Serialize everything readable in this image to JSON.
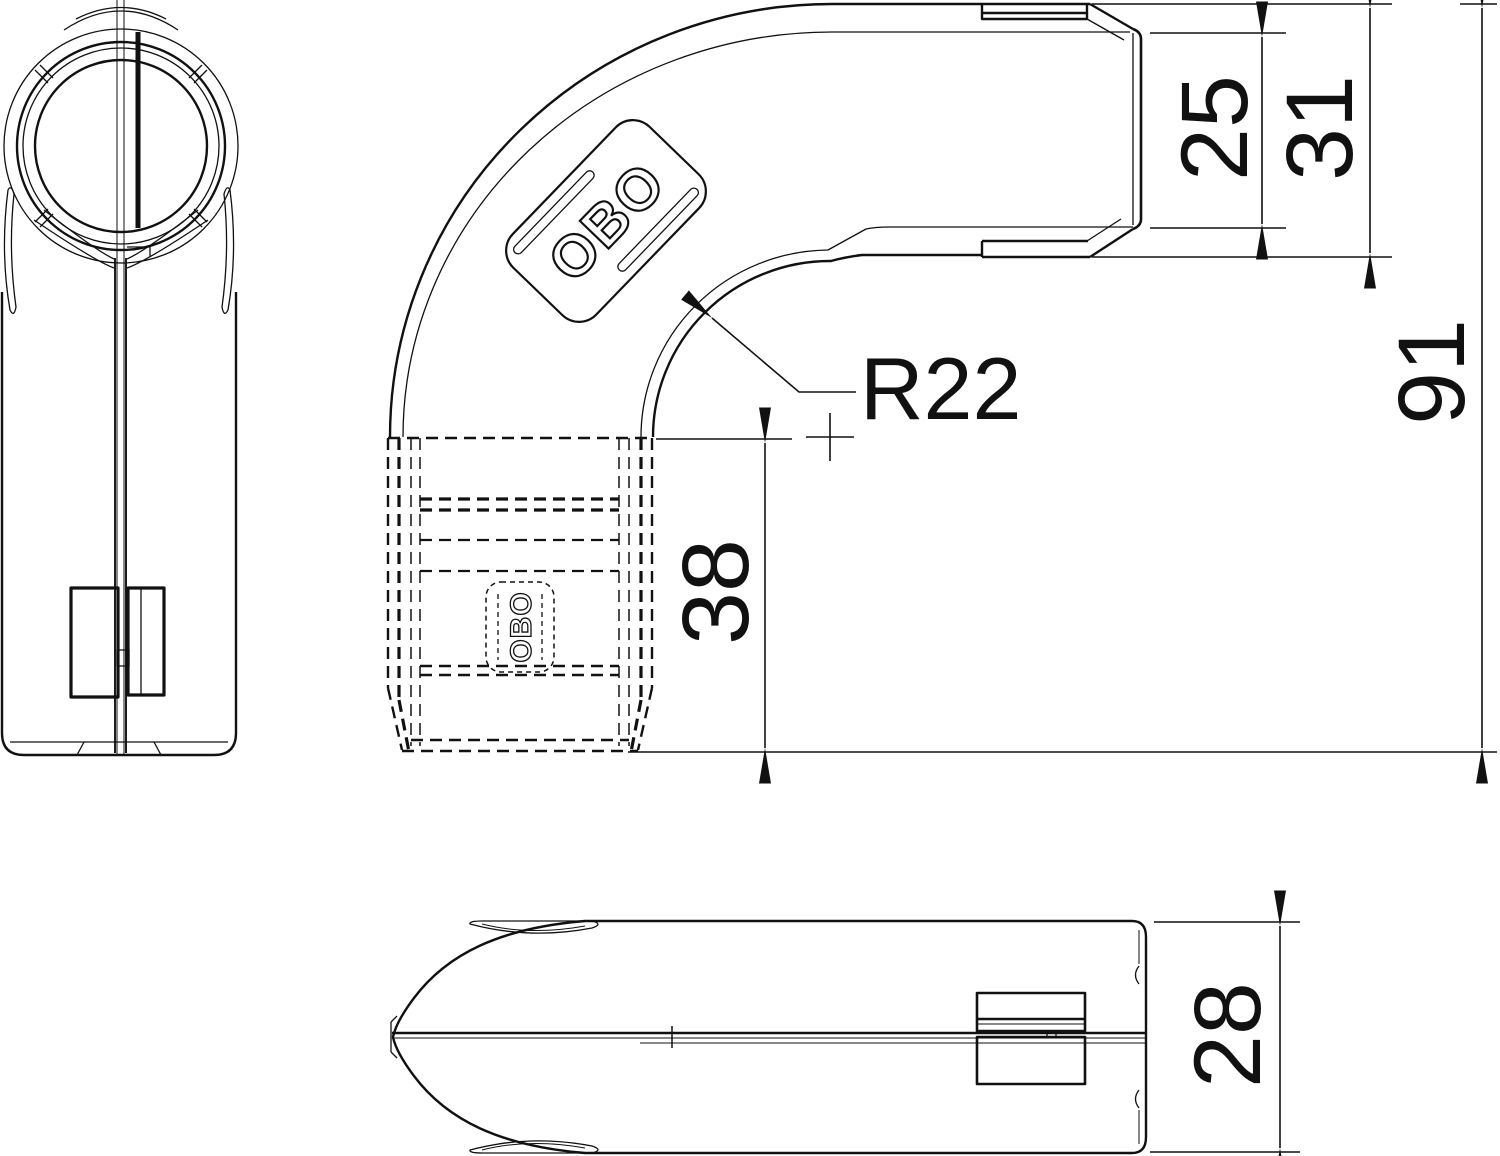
{
  "colors": {
    "background": "#ffffff",
    "line": "#111111"
  },
  "logo": {
    "front_badge": "OBO",
    "hidden_badge": "OBO"
  },
  "dimensions": {
    "socket_inner_width": {
      "label": "25"
    },
    "socket_outer_width": {
      "label": "31"
    },
    "overall_length": {
      "label": "91"
    },
    "bend_radius": {
      "label": "R22"
    },
    "insertion_depth": {
      "label": "38"
    },
    "profile_height": {
      "label": "28"
    }
  }
}
